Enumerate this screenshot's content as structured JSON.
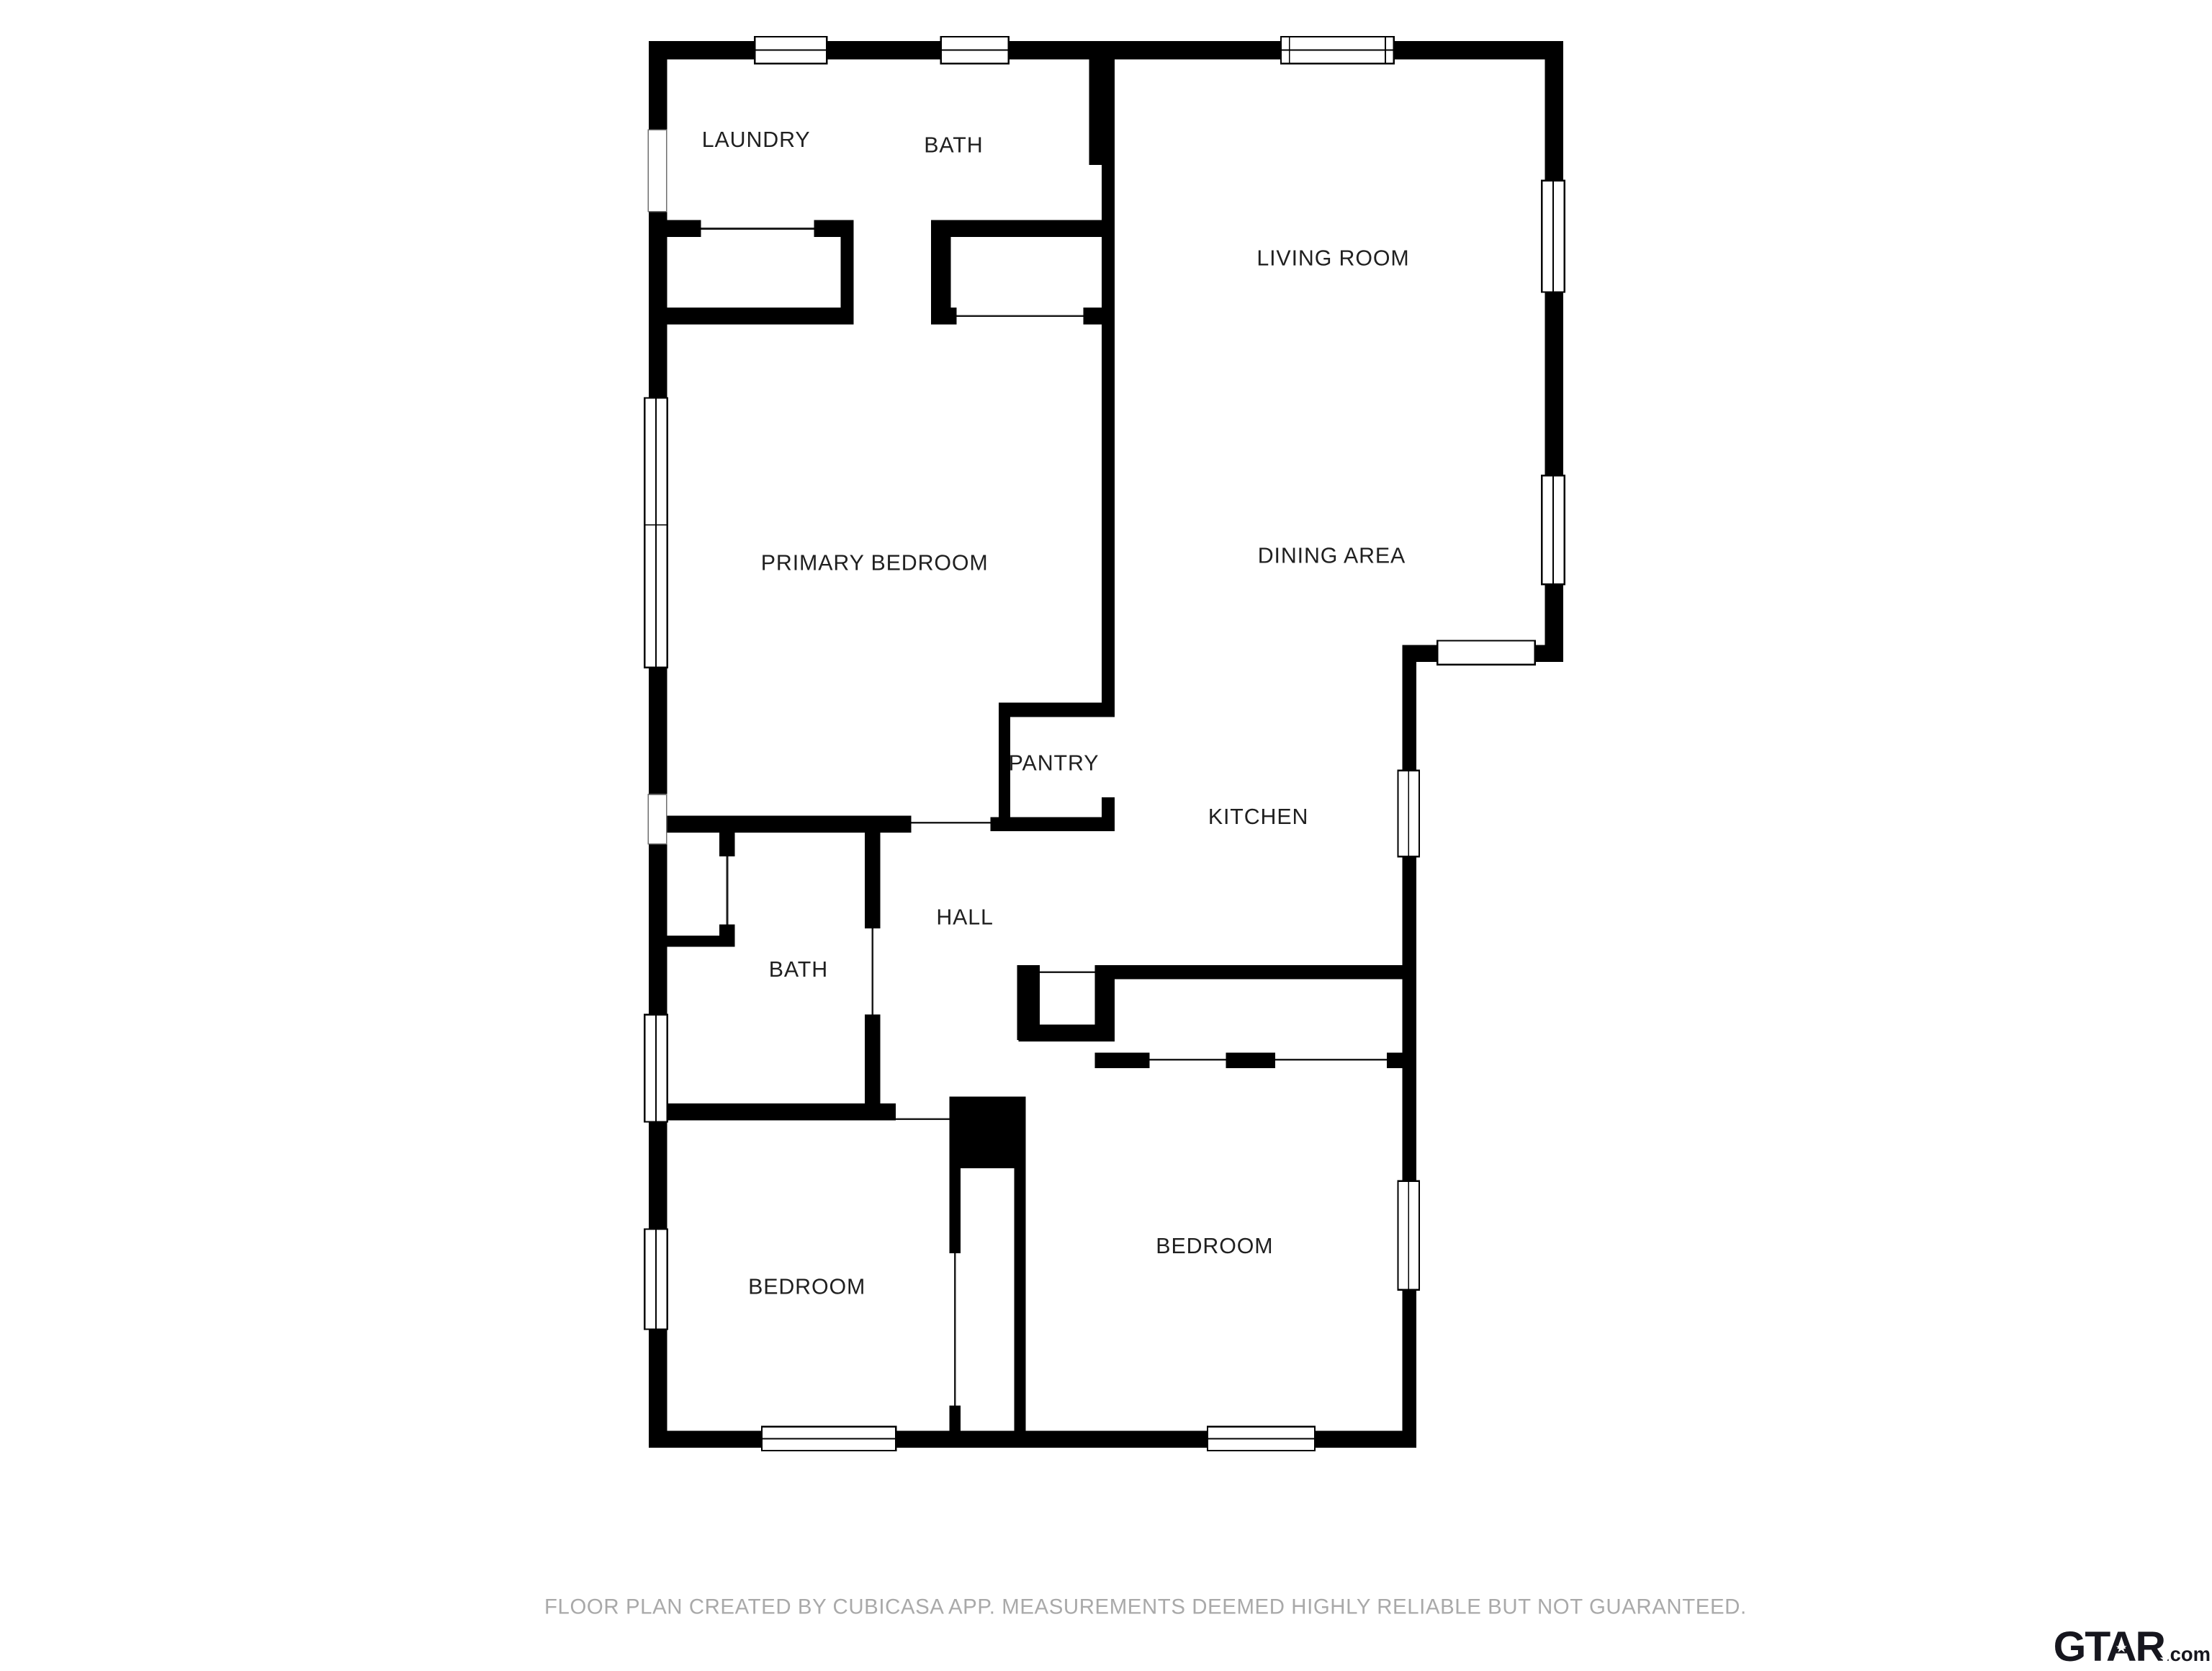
{
  "floor_plan": {
    "wall_color": "#000000",
    "label_color": "#202020",
    "rooms": [
      {
        "id": "laundry",
        "label": "LAUNDRY"
      },
      {
        "id": "bath-upper",
        "label": "BATH"
      },
      {
        "id": "living-room",
        "label": "LIVING ROOM"
      },
      {
        "id": "dining-area",
        "label": "DINING AREA"
      },
      {
        "id": "primary-bedroom",
        "label": "PRIMARY BEDROOM"
      },
      {
        "id": "pantry",
        "label": "PANTRY"
      },
      {
        "id": "kitchen",
        "label": "KITCHEN"
      },
      {
        "id": "hall",
        "label": "HALL"
      },
      {
        "id": "bath-lower",
        "label": "BATH"
      },
      {
        "id": "bedroom-left",
        "label": "BEDROOM"
      },
      {
        "id": "bedroom-right",
        "label": "BEDROOM"
      }
    ]
  },
  "footer": {
    "disclaimer": "FLOOR PLAN CREATED BY CUBICASA APP. MEASUREMENTS DEEMED HIGHLY RELIABLE BUT NOT GUARANTEED.",
    "color": "#a9a9a9"
  },
  "branding": {
    "site_name": "GTAR",
    "domain_suffix": ".com",
    "star": "★",
    "color": "#16161e"
  }
}
